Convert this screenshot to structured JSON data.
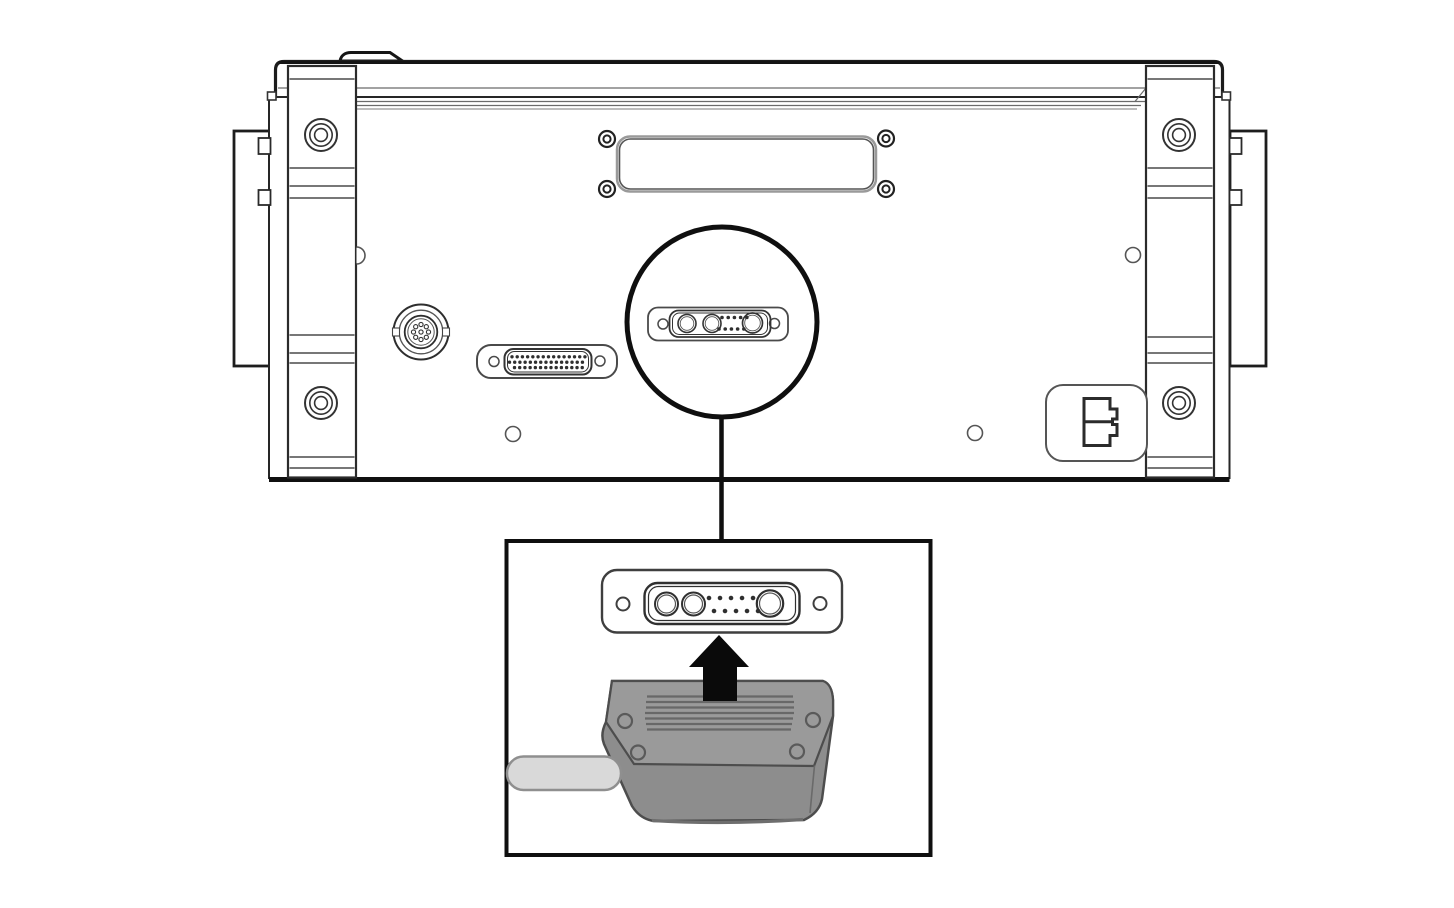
{
  "meta": {
    "title": "Rear panel connector installation diagram"
  },
  "colors": {
    "background": "#ffffff",
    "ink": "#1a1a1a",
    "ink_medium": "#4a4a4a",
    "ink_soft": "#707070",
    "callout": "#0f0f0f",
    "arrow": "#0a0a0a",
    "plug_top": "#9a9a9a",
    "plug_front": "#8d8d8d",
    "plug_outline": "#4d4d4d",
    "plug_ribs": "#686868",
    "plug_lip": "#6e6e6e",
    "cable_fill": "#d9d9d9",
    "cable_stroke": "#8f8f8f",
    "panel_fill": "#ffffff"
  },
  "rear_panel": {
    "rack_ears": {
      "count": 2,
      "screws_per_ear": 2
    },
    "side_panels": {
      "count": 2,
      "tabs_per_panel": 2
    },
    "top_tab": {
      "count": 1
    },
    "blank_plate": {
      "screws": 4
    },
    "connectors": {
      "circular_din": {
        "style": "circular multi-pin",
        "pins": 9
      },
      "dsub_44": {
        "style": "high-density D-sub",
        "pin_rows": [
          15,
          15,
          14
        ]
      },
      "combo_13w3": {
        "style": "combo D-sub",
        "large_pins": 3,
        "small_pins": 10,
        "mounting_holes": 2
      },
      "power_inlet": {
        "style": "keyed 2-slot inlet"
      }
    },
    "holes": {
      "count": 3
    }
  },
  "callout": {
    "shape": "circle",
    "leader": "vertical line",
    "highlights": "combo_13w3"
  },
  "detail_inset": {
    "connector": {
      "style": "combo D-sub",
      "large_pins": 3,
      "small_pins": 10,
      "mounting_holes": 2
    },
    "arrow_direction": "up",
    "plug": {
      "screws": 4,
      "ribs": 7
    },
    "cable": {
      "exit": "left"
    }
  }
}
